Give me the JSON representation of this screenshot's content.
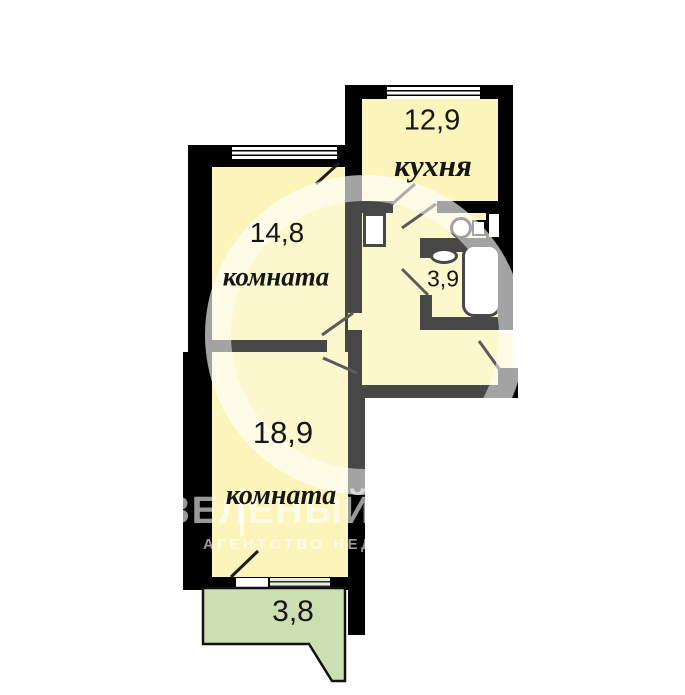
{
  "plan_title": "apartment-floor-plan",
  "rooms": {
    "kitchen": {
      "name": "кухня",
      "area": "12,9"
    },
    "room1": {
      "name": "комната",
      "area": "14,8"
    },
    "bathroom": {
      "area": "3,9"
    },
    "room2": {
      "name": "комната",
      "area": "18,9"
    },
    "balcony": {
      "area": "3,8"
    }
  },
  "watermark": {
    "title": "ЗЕЛЕНЫЙ",
    "subtitle": "АГЕНТСТВО НЕДВИ"
  },
  "colors": {
    "wall": "#000000",
    "room_fill": "#fbf5bb",
    "balcony_fill": "#cbdfb2",
    "balcony_window_fill": "#e9efda",
    "watermark": "rgba(255,255,255,0.6)"
  }
}
